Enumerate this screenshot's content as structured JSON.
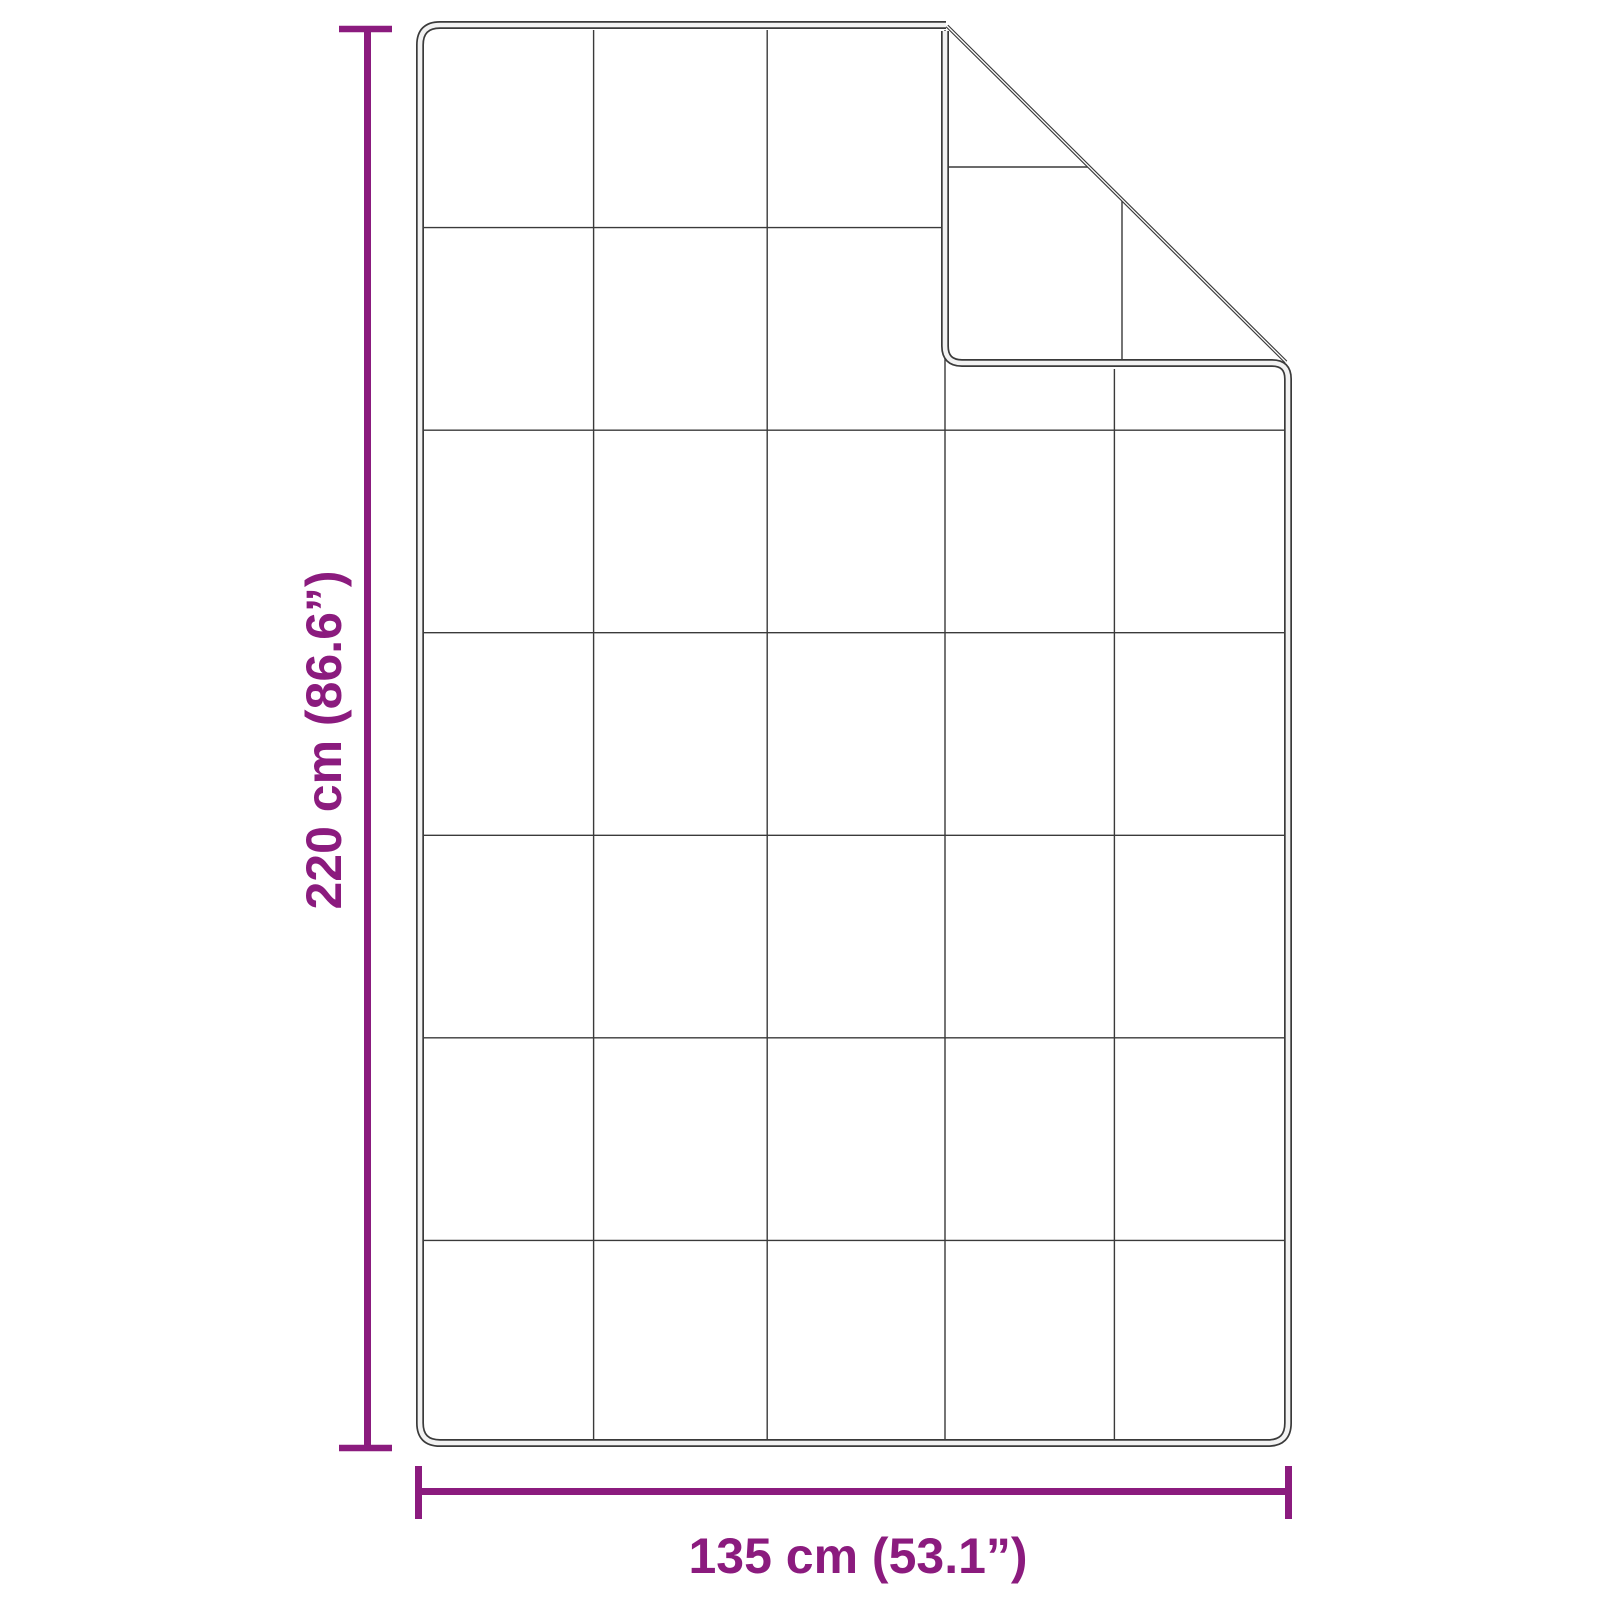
{
  "page": {
    "background": "#FFFFFF"
  },
  "colors": {
    "accent_purple": "#8B1B7E",
    "outline_gray": "#3A3A3A",
    "hem_core_gray": "#F2F2F2"
  },
  "blanket": {
    "description": "weighted-blanket top view with folded top-right corner",
    "grid_rows": 7,
    "grid_columns": 5
  },
  "dimensions": {
    "height": {
      "label": "220 cm (86.6”)",
      "value_cm": 220,
      "value_in": 86.6
    },
    "width": {
      "label": "135 cm (53.1”)",
      "value_cm": 135,
      "value_in": 53.1
    }
  }
}
